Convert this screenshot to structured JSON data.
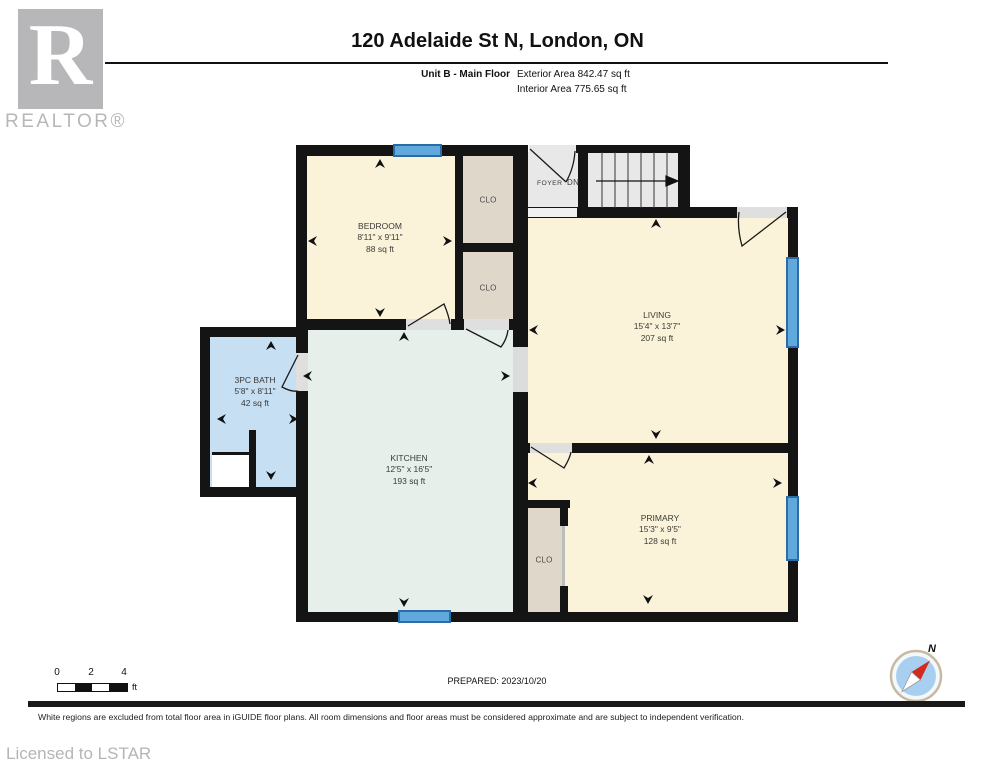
{
  "header": {
    "title": "120 Adelaide St N, London, ON",
    "unit_label": "Unit B - Main Floor",
    "exterior_area": "Exterior Area 842.47 sq ft",
    "interior_area": "Interior Area 775.65 sq ft"
  },
  "branding": {
    "realtor_logo_letter": "R",
    "realtor_logo_text": "REALTOR®",
    "license_text": "Licensed to LSTAR"
  },
  "rooms": {
    "bedroom": {
      "name": "BEDROOM",
      "dims": "8'11\" x 9'11\"",
      "area": "88 sq ft"
    },
    "living": {
      "name": "LIVING",
      "dims": "15'4\" x 13'7\"",
      "area": "207 sq ft"
    },
    "bath": {
      "name": "3PC BATH",
      "dims": "5'8\" x 8'11\"",
      "area": "42 sq ft"
    },
    "kitchen": {
      "name": "KITCHEN",
      "dims": "12'5\" x 16'5\"",
      "area": "193 sq ft"
    },
    "primary": {
      "name": "PRIMARY",
      "dims": "15'3\" x 9'5\"",
      "area": "128 sq ft"
    },
    "foyer": {
      "name": "FOYER"
    },
    "closet1": {
      "name": "CLO"
    },
    "closet2": {
      "name": "CLO"
    },
    "closet3": {
      "name": "CLO"
    },
    "stairs_label": "DN"
  },
  "footer": {
    "scale_ticks": [
      "0",
      "2",
      "4"
    ],
    "scale_unit": "ft",
    "prepared": "PREPARED: 2023/10/20",
    "disclaimer": "White regions are excluded from total floor area in iGUIDE floor plans. All room dimensions and floor areas must be considered approximate and are subject to independent verification.",
    "compass_label": "N"
  },
  "colors": {
    "wall": "#141414",
    "room_cream": "#FBF3D9",
    "room_mint": "#E6EFE9",
    "room_blue": "#C6DFF3",
    "closet_beige": "#DFD8CA",
    "hall_gray": "#E8E8E8",
    "window_blue": "#5FA9DC",
    "window_frame": "#2B6CA8",
    "compass_red": "#D22A1E",
    "logo_gray": "#B7B7B9"
  }
}
